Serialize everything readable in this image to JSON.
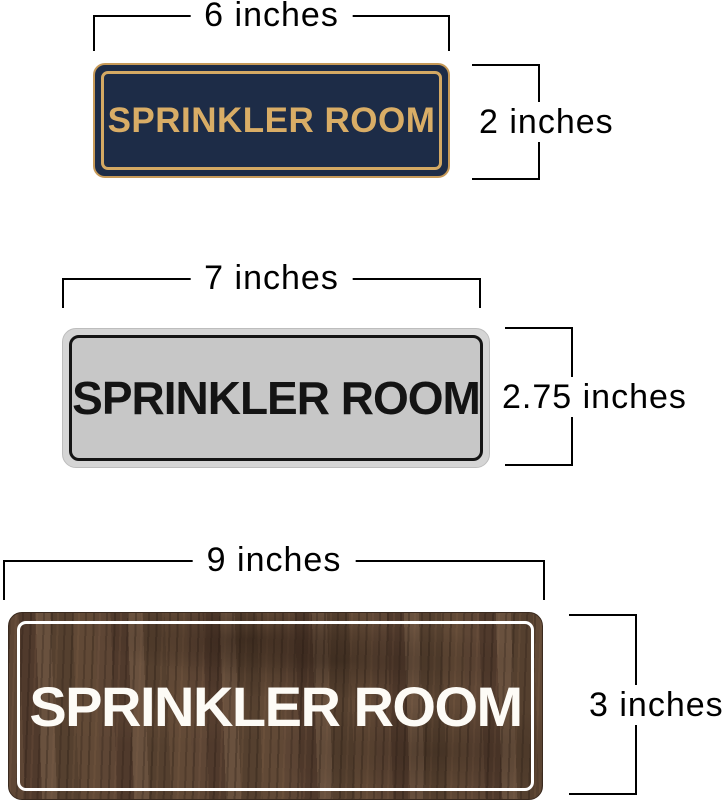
{
  "figure": {
    "background": "#ffffff",
    "dimension_line_color": "#000000"
  },
  "signs": [
    {
      "name": "navy-gold-sprinkler-sign",
      "text": "SPRINKLER ROOM",
      "width_label": "6 inches",
      "height_label": "2 inches",
      "colors": {
        "plate": "#1d2c47",
        "trim": "#d4a963",
        "text": "#d9ad66"
      }
    },
    {
      "name": "silver-black-sprinkler-sign",
      "text": "SPRINKLER ROOM",
      "width_label": "7 inches",
      "height_label": "2.75 inches",
      "colors": {
        "plate": "#c7c7c7",
        "rim": "#d5d5d5",
        "trim": "#141414",
        "text": "#141414"
      }
    },
    {
      "name": "walnut-white-sprinkler-sign",
      "text": "SPRINKLER ROOM",
      "width_label": "9 inches",
      "height_label": "3 inches",
      "colors": {
        "plate": "#57402f",
        "trim": "#ffffff",
        "text": "#fdfbf6"
      }
    }
  ]
}
